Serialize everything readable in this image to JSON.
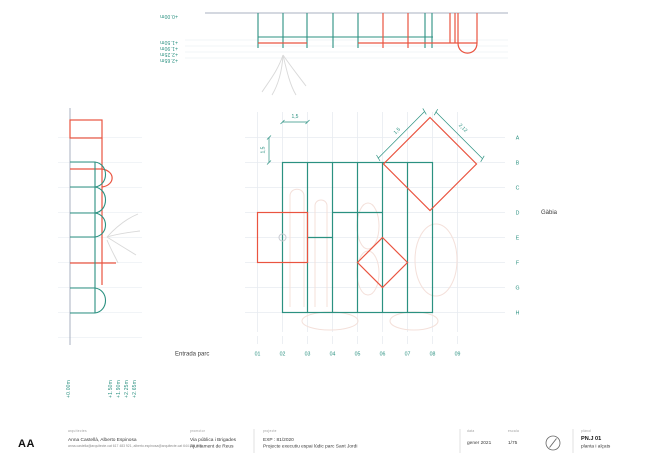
{
  "colors": {
    "teal": "#2b9181",
    "orange": "#ea5440",
    "gray_line": "#a8b1c0",
    "faint_grid": "#e7ebf0",
    "ghost_pink": "#f4e0da",
    "sketch_gray": "#d9d9d9"
  },
  "top_section": {
    "levels": [
      "+0.00m",
      "+1.50m",
      "+1.90m",
      "+2.25m",
      "+2.65m"
    ]
  },
  "left_section": {
    "levels": [
      "+0.00m",
      "+1.50m",
      "+1.90m",
      "+2.25m",
      "+2.65m"
    ]
  },
  "plan": {
    "rows": [
      "A",
      "B",
      "C",
      "D",
      "E",
      "F",
      "G",
      "H"
    ],
    "cols": [
      "01",
      "02",
      "03",
      "04",
      "05",
      "06",
      "07",
      "08",
      "09"
    ],
    "labels": {
      "entrance": "Entrada parc",
      "cage": "Gàbia"
    },
    "dimensions": {
      "module_h": "1,5",
      "module_v": "1,5",
      "diamond_side": "1,5",
      "diamond_diagonal": "2,12"
    }
  },
  "section_mark": "AA",
  "title_block": {
    "architects": {
      "header": "arquitectes",
      "name": "Anna Castellà, Alberto Espinosa",
      "contact": "anna.castella@arquitecte.cat 617 483 921, alberto.espinosa@arquitecte.cat 644 851 723"
    },
    "promoter": {
      "header": "promotor",
      "line1": "Via pública i Brigades",
      "line2": "Ajuntament de Reus"
    },
    "project": {
      "header": "projecte",
      "exp": "EXP : 81/2020",
      "name": "Projecte executiu espai lúdic parc Sant Jordi"
    },
    "date": {
      "header": "data",
      "value": "gener 2021"
    },
    "scale": {
      "header": "escala",
      "value": "1/75"
    },
    "sheet": {
      "header": "plànol",
      "code": "PN.J 01",
      "name": "planta i alçats"
    }
  }
}
